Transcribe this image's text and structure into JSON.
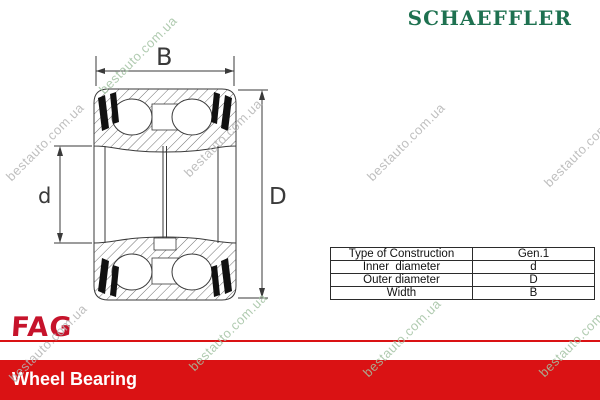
{
  "header": {
    "brand": "SCHAEFFLER"
  },
  "drawing": {
    "labels": {
      "width": "B",
      "inner_diameter": "d",
      "outer_diameter": "D"
    }
  },
  "spec_table": {
    "rows": [
      {
        "label": "Type of Construction",
        "value": "Gen.1"
      },
      {
        "label": "Inner  diameter",
        "value": "d"
      },
      {
        "label": "Outer diameter",
        "value": "D"
      },
      {
        "label": "Width",
        "value": "B"
      }
    ]
  },
  "footer": {
    "brand": "FAG",
    "title": "Wheel Bearing"
  },
  "watermark": {
    "text": "bestauto.com.ua"
  },
  "colors": {
    "schaeffler_green": "#1e7150",
    "fag_red": "#c6132b",
    "footer_red": "#da1214",
    "watermark_gray": "#b5b5b5",
    "watermark_green": "#a3c2a3",
    "line_color": "#3a3a3a"
  }
}
